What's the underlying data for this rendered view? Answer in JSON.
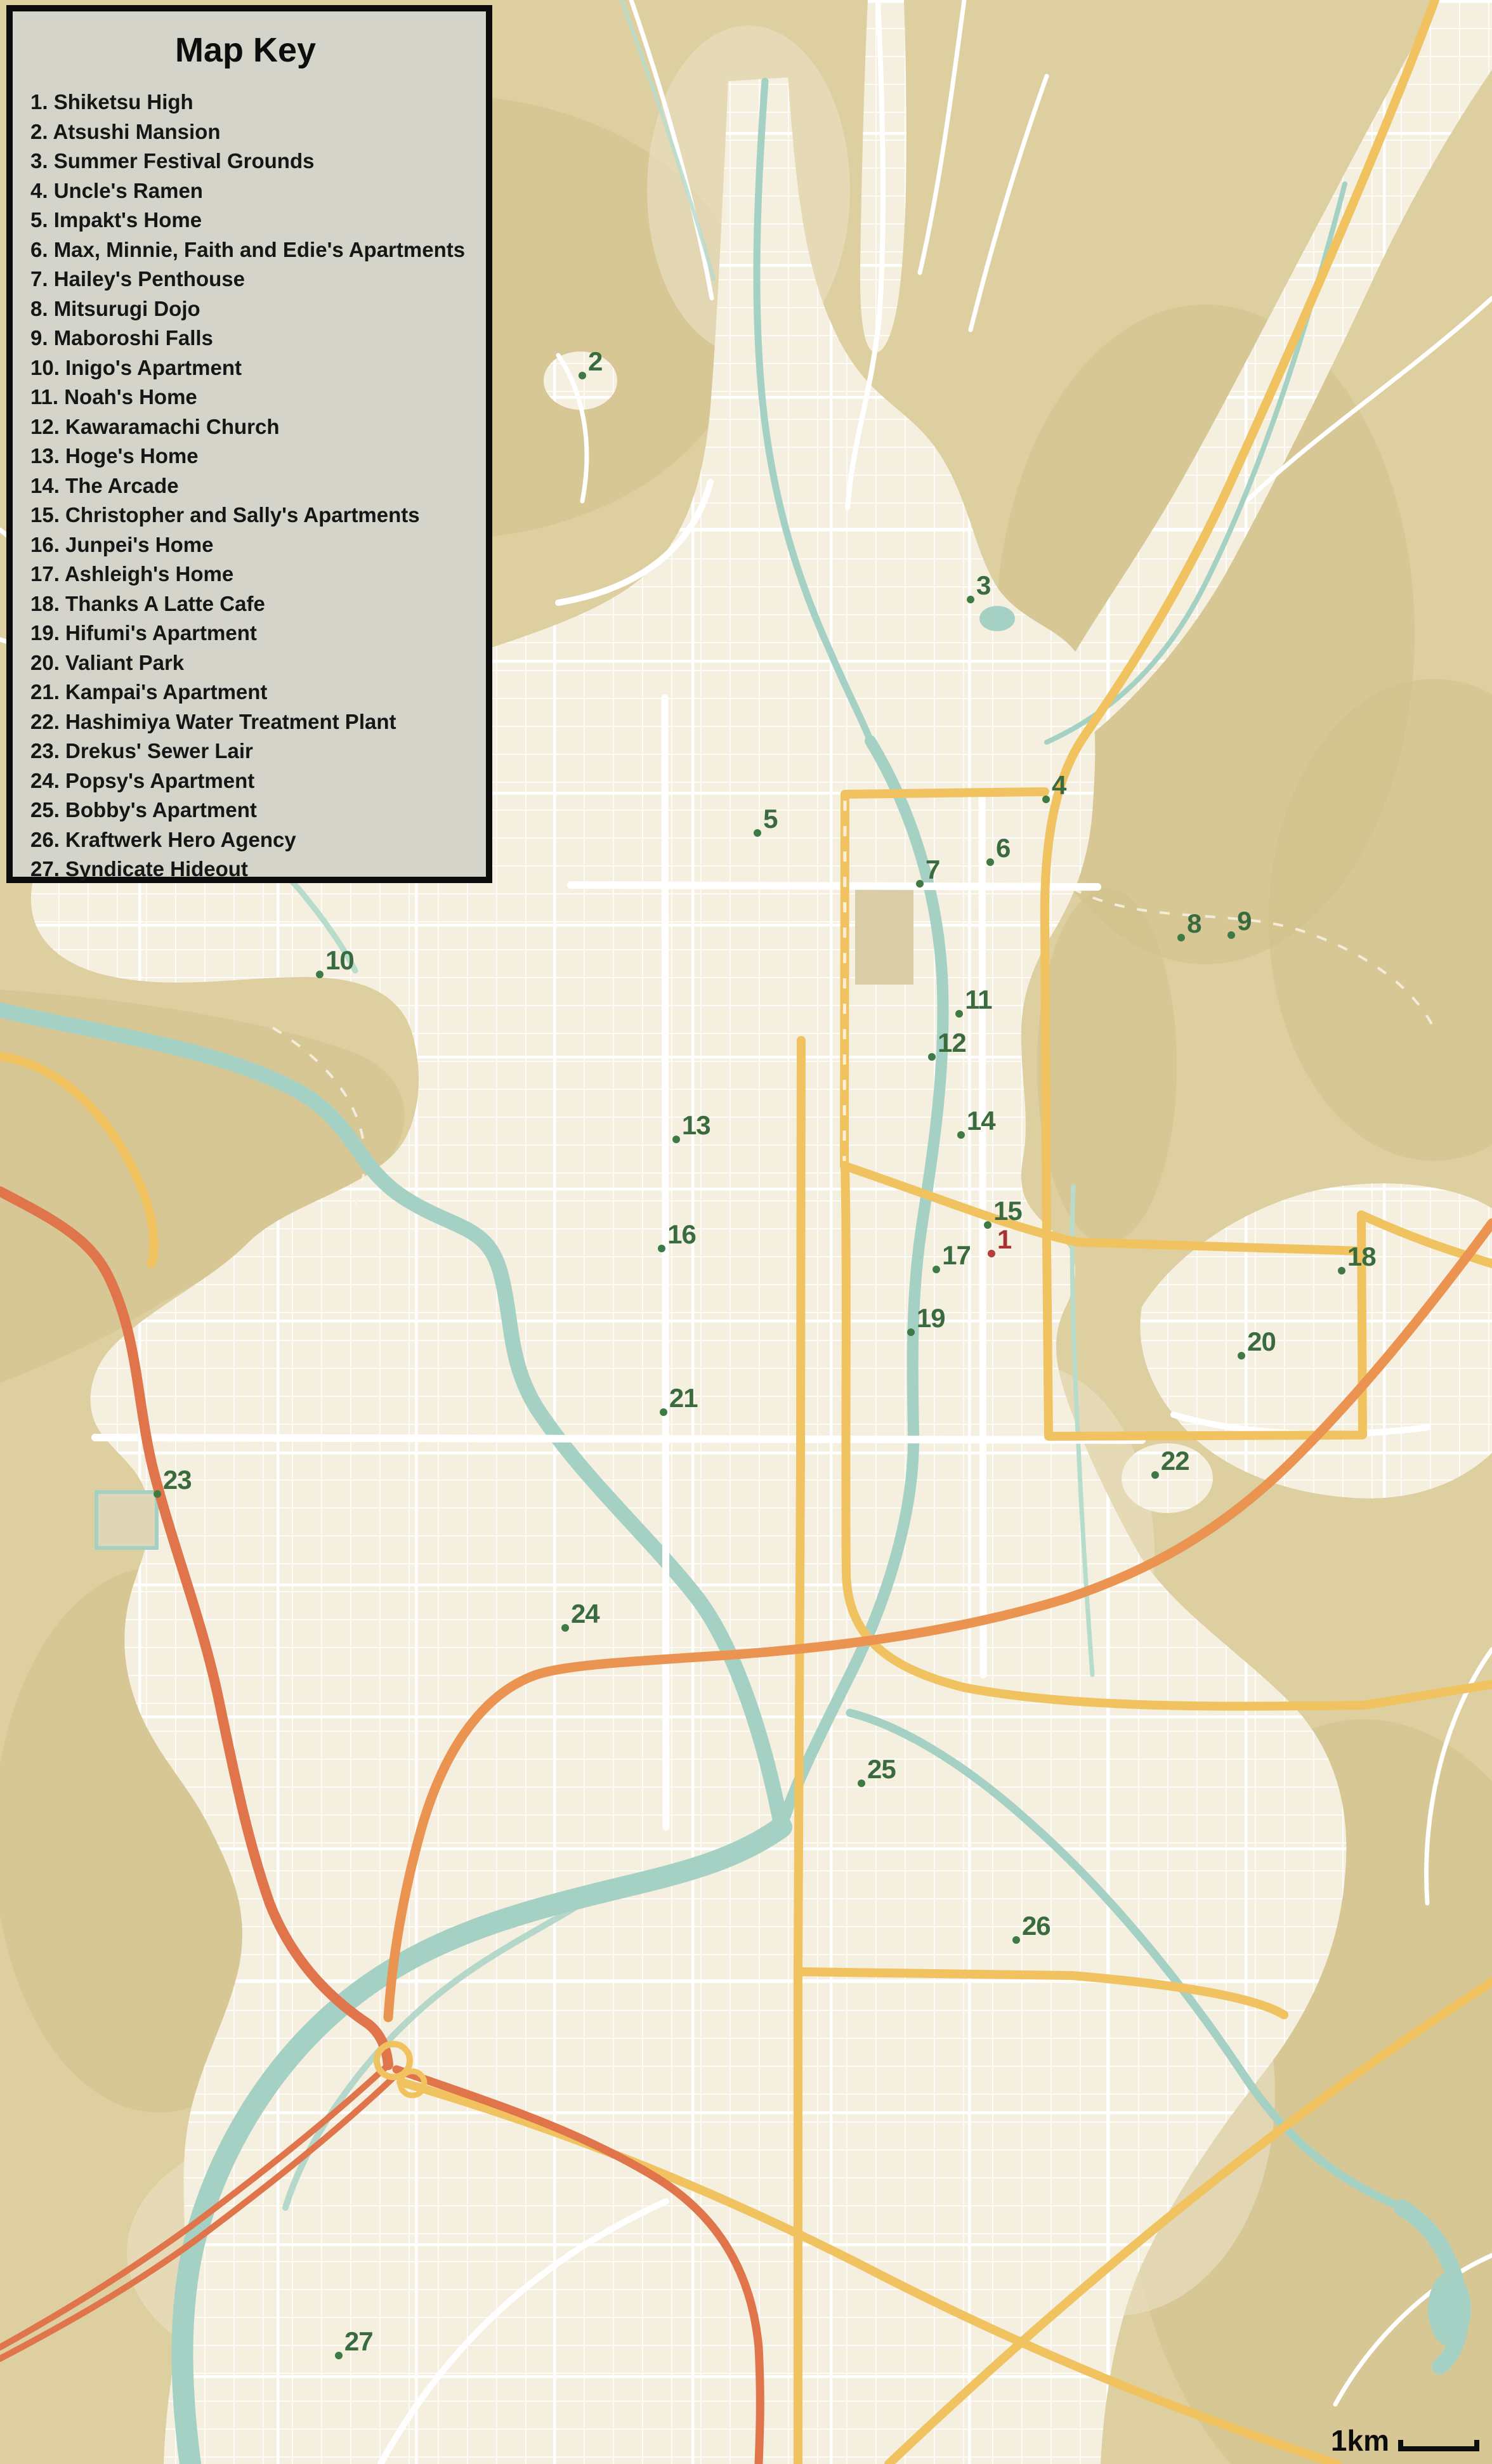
{
  "map_key": {
    "title": "Map Key",
    "items": [
      "1. Shiketsu High",
      "2. Atsushi Mansion",
      "3. Summer Festival Grounds",
      "4. Uncle's Ramen",
      "5. Impakt's Home",
      "6. Max, Minnie, Faith and Edie's Apartments",
      "7. Hailey's Penthouse",
      "8. Mitsurugi Dojo",
      "9. Maboroshi Falls",
      "10. Inigo's Apartment",
      "11. Noah's Home",
      "12. Kawaramachi Church",
      "13. Hoge's Home",
      "14. The Arcade",
      "15. Christopher and Sally's Apartments",
      "16. Junpei's Home",
      "17. Ashleigh's Home",
      "18. Thanks A Latte Cafe",
      "19. Hifumi's Apartment",
      "20. Valiant Park",
      "21. Kampai's Apartment",
      "22. Hashimiya Water Treatment Plant",
      "23. Drekus' Sewer Lair",
      "24. Popsy's Apartment",
      "25. Bobby's Apartment",
      "26. Kraftwerk Hero Agency",
      "27. Syndicate Hideout"
    ]
  },
  "markers": [
    {
      "num": "1",
      "color": "red",
      "x_pct": 66.45,
      "y_pct": 50.88
    },
    {
      "num": "2",
      "color": "green",
      "x_pct": 39.03,
      "y_pct": 15.24
    },
    {
      "num": "3",
      "color": "green",
      "x_pct": 65.05,
      "y_pct": 24.33
    },
    {
      "num": "4",
      "color": "green",
      "x_pct": 70.11,
      "y_pct": 32.44
    },
    {
      "num": "5",
      "color": "green",
      "x_pct": 50.77,
      "y_pct": 33.81
    },
    {
      "num": "6",
      "color": "green",
      "x_pct": 66.37,
      "y_pct": 34.99
    },
    {
      "num": "7",
      "color": "green",
      "x_pct": 61.65,
      "y_pct": 35.87
    },
    {
      "num": "8",
      "color": "green",
      "x_pct": 79.17,
      "y_pct": 38.05
    },
    {
      "num": "9",
      "color": "green",
      "x_pct": 82.53,
      "y_pct": 37.95
    },
    {
      "num": "10",
      "color": "green",
      "x_pct": 21.43,
      "y_pct": 39.55
    },
    {
      "num": "11",
      "color": "green",
      "x_pct": 64.29,
      "y_pct": 41.14
    },
    {
      "num": "12",
      "color": "green",
      "x_pct": 62.46,
      "y_pct": 42.89
    },
    {
      "num": "13",
      "color": "green",
      "x_pct": 45.32,
      "y_pct": 46.24
    },
    {
      "num": "14",
      "color": "green",
      "x_pct": 64.41,
      "y_pct": 46.06
    },
    {
      "num": "15",
      "color": "green",
      "x_pct": 66.2,
      "y_pct": 49.72
    },
    {
      "num": "16",
      "color": "green",
      "x_pct": 44.35,
      "y_pct": 50.67
    },
    {
      "num": "17",
      "color": "green",
      "x_pct": 62.76,
      "y_pct": 51.52
    },
    {
      "num": "18",
      "color": "green",
      "x_pct": 89.92,
      "y_pct": 51.57
    },
    {
      "num": "19",
      "color": "green",
      "x_pct": 61.05,
      "y_pct": 54.07
    },
    {
      "num": "20",
      "color": "green",
      "x_pct": 83.21,
      "y_pct": 55.02
    },
    {
      "num": "21",
      "color": "green",
      "x_pct": 44.47,
      "y_pct": 57.31
    },
    {
      "num": "22",
      "color": "green",
      "x_pct": 77.42,
      "y_pct": 59.86
    },
    {
      "num": "23",
      "color": "green",
      "x_pct": 10.54,
      "y_pct": 60.63
    },
    {
      "num": "24",
      "color": "green",
      "x_pct": 37.88,
      "y_pct": 66.07
    },
    {
      "num": "25",
      "color": "green",
      "x_pct": 57.74,
      "y_pct": 72.37
    },
    {
      "num": "26",
      "color": "green",
      "x_pct": 68.11,
      "y_pct": 78.73
    },
    {
      "num": "27",
      "color": "green",
      "x_pct": 22.7,
      "y_pct": 95.6
    }
  ],
  "scale_bar": {
    "label": "1km"
  },
  "colors": {
    "tan": "#decfa1",
    "mtn": "#d0bf8a",
    "foothill": "#e9dfc2",
    "cream": "#f4efdf",
    "water": "#a5d1c4",
    "stream": "#b7dccc",
    "yellow": "#f0c360",
    "orange": "#eb9351",
    "redhwy": "#e0744a",
    "marker-green": "#3e7a44",
    "label-green": "#3a6b3e",
    "marker-red": "#b43d3d",
    "label-red": "#a83232",
    "key-bg": "#d5d4ca",
    "key-border": "#0b0b0b",
    "ink": "#161616"
  }
}
